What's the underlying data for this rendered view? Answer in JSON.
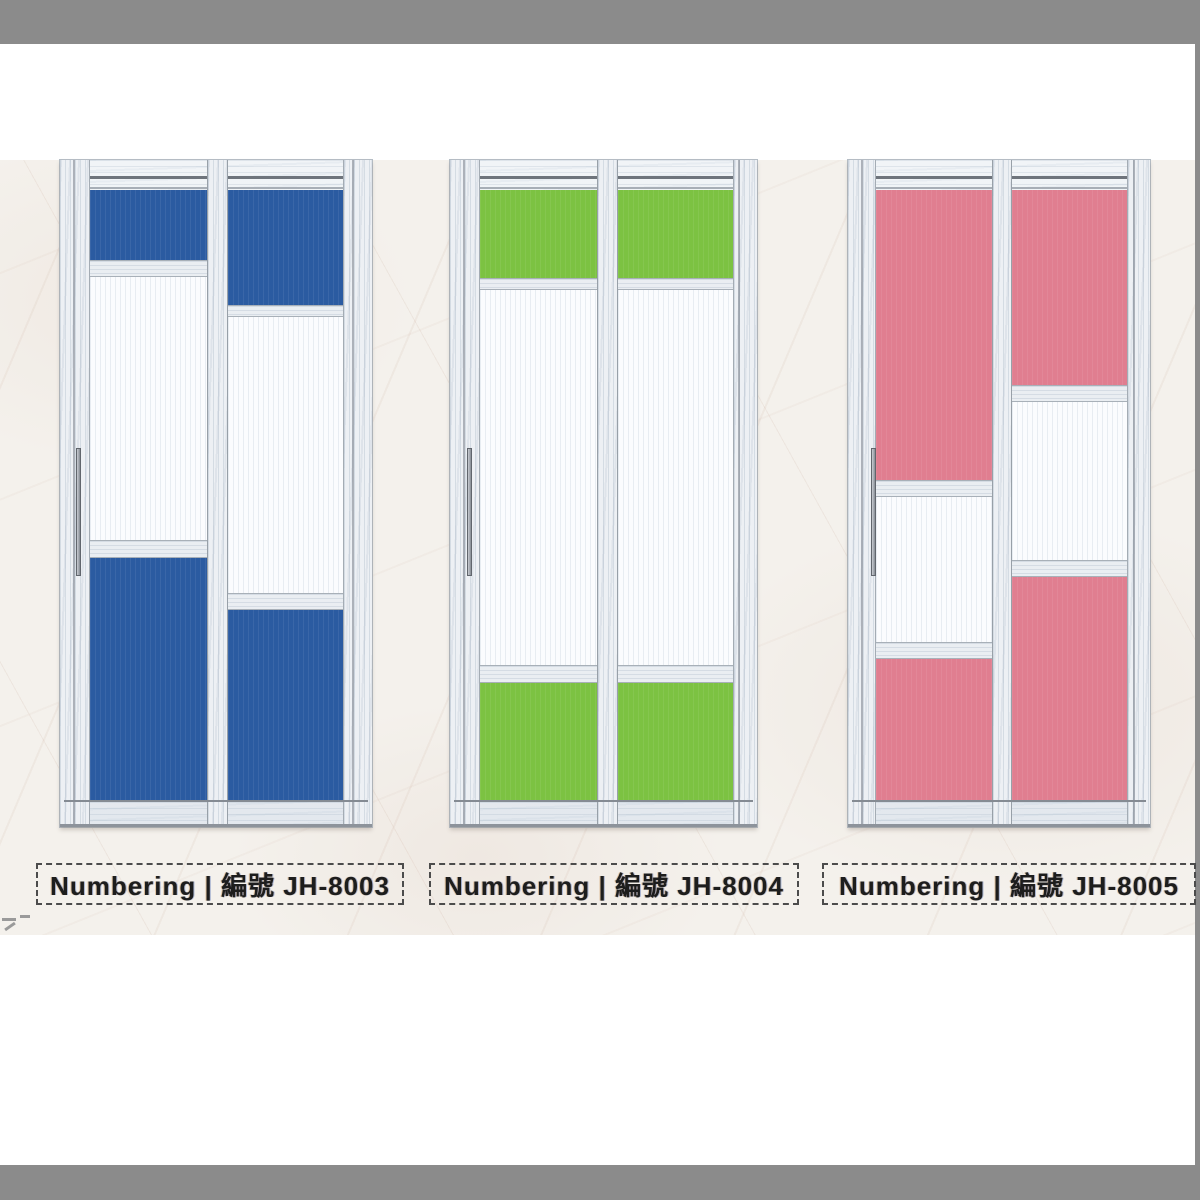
{
  "page": {
    "frame_color": "#8b8b8b",
    "paper_color": "#f4f1ec"
  },
  "catalog": {
    "field_label_en": "Numbering",
    "separator": "|",
    "field_label_zh": "編號",
    "products": [
      {
        "code": "JH-8003",
        "label": "Numbering | 編號 JH-8003",
        "glass_color": "#2b5ba1",
        "color_name": "blue"
      },
      {
        "code": "JH-8004",
        "label": "Numbering | 編號 JH-8004",
        "glass_color": "#7cc242",
        "color_name": "green"
      },
      {
        "code": "JH-8005",
        "label": "Numbering | 編號 JH-8005",
        "glass_color": "#e07e90",
        "color_name": "pink"
      }
    ]
  }
}
